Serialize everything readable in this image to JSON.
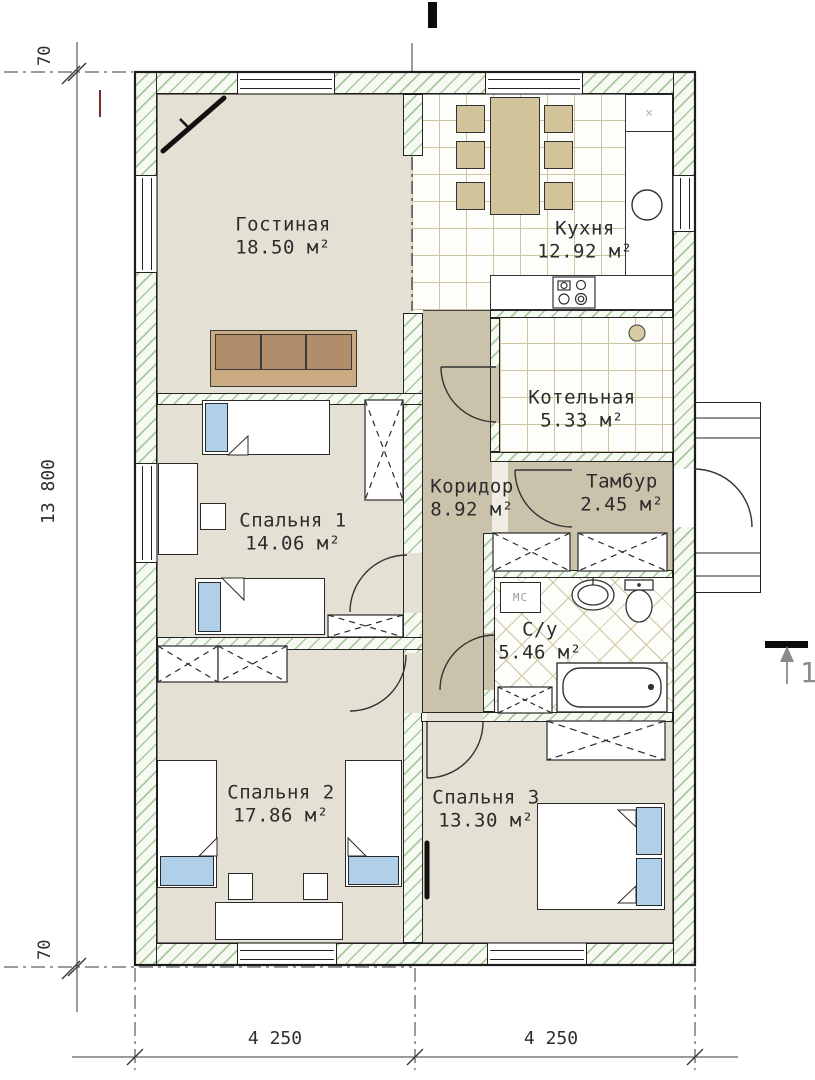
{
  "drawing_type": "house floor plan",
  "rooms": [
    {
      "id": "living",
      "name": "Гостиная",
      "area": "18.50 м²"
    },
    {
      "id": "kitchen",
      "name": "Кухня",
      "area": "12.92 м²"
    },
    {
      "id": "boiler",
      "name": "Котельная",
      "area": "5.33 м²"
    },
    {
      "id": "corridor",
      "name": "Коридор",
      "area": "8.92 м²"
    },
    {
      "id": "vestibule",
      "name": "Тамбур",
      "area": "2.45 м²"
    },
    {
      "id": "bedroom1",
      "name": "Спальня 1",
      "area": "14.06 м²"
    },
    {
      "id": "bathroom",
      "name": "С/у",
      "area": "5.46 м²"
    },
    {
      "id": "bedroom2",
      "name": "Спальня 2",
      "area": "17.86 м²"
    },
    {
      "id": "bedroom3",
      "name": "Спальня 3",
      "area": "13.30 м²"
    }
  ],
  "dimensions": {
    "left_total": "13 800",
    "top_offset": "70",
    "bottom_offset": "70",
    "bottom_span_left": "4 250",
    "bottom_span_right": "4 250"
  },
  "marks": {
    "section_number": "1",
    "washing_machine": "МС",
    "counter_cross": "×"
  },
  "colors": {
    "wall_hatch": "#a8c8a0",
    "floor_beige": "#e5e0d4",
    "floor_hall": "#cbc2ab",
    "furniture_tan": "#d3c39b",
    "sofa_brown": "#b08e6b",
    "textile_blue": "#b0d0ea",
    "line_black": "#222222",
    "dim_grey": "#3a3a3a",
    "mark_grey": "#8a8a8a",
    "red_tick": "#7b2b2b"
  }
}
